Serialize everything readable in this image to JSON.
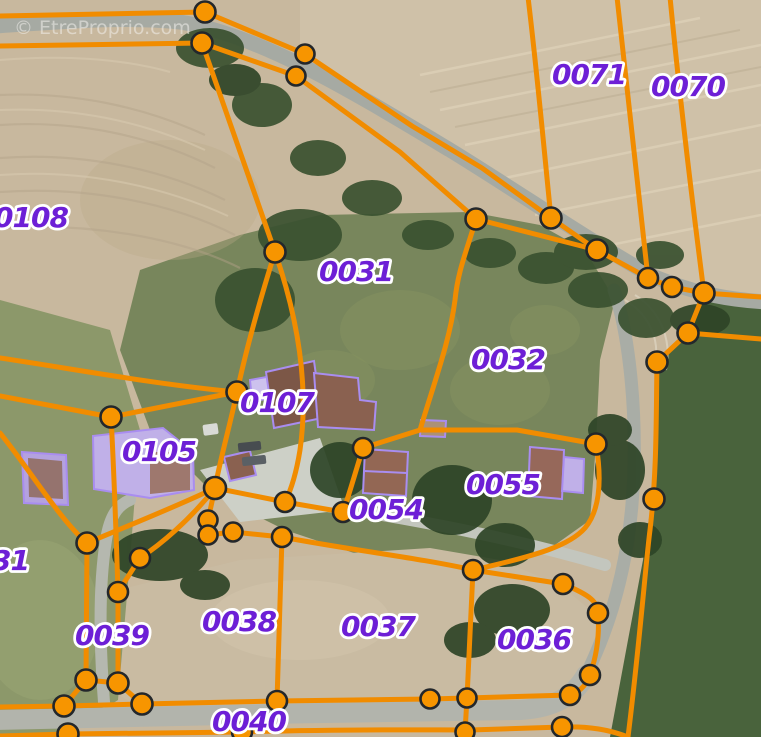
{
  "watermark": "© EtreProprio.com",
  "colors": {
    "boundary": "#f18c00",
    "node": "#f79500",
    "node_ring": "#23272b",
    "label": "#6d1fd6",
    "building_outline": "#a98df0"
  },
  "parcels": [
    {
      "number": "0108"
    },
    {
      "number": "0031"
    },
    {
      "number": "0032"
    },
    {
      "number": "0071"
    },
    {
      "number": "0070"
    },
    {
      "number": "0107"
    },
    {
      "number": "0105"
    },
    {
      "number": "0055"
    },
    {
      "number": "0054"
    },
    {
      "number": "0039"
    },
    {
      "number": "0038"
    },
    {
      "number": "0037"
    },
    {
      "number": "0036"
    },
    {
      "number": "0040"
    },
    {
      "number": "31"
    }
  ]
}
